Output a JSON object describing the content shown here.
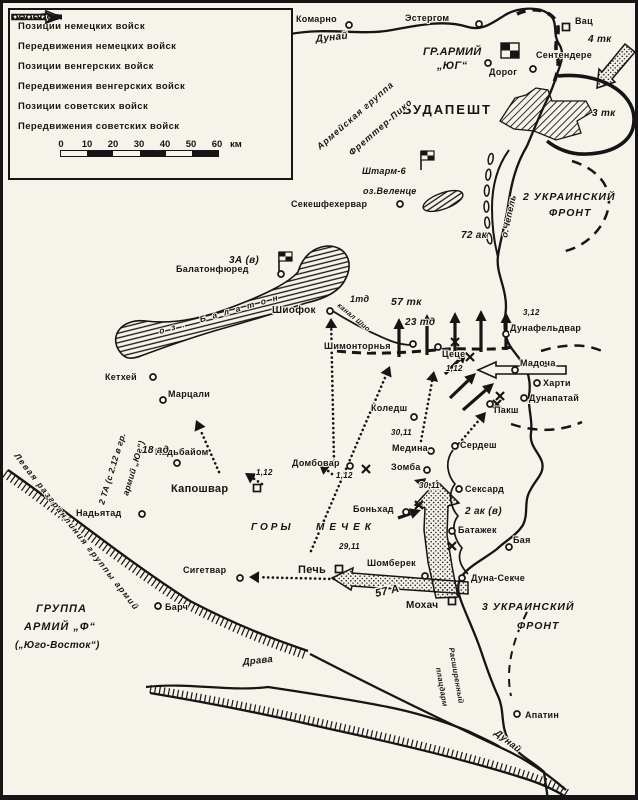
{
  "colors": {
    "paper": "#f5f3ea",
    "ink": "#151515"
  },
  "legend": {
    "items": [
      {
        "id": "german-positions",
        "label": "Позиции немецких войск"
      },
      {
        "id": "german-movements",
        "label": "Передвижения немецких войск"
      },
      {
        "id": "hungarian-positions",
        "label": "Позиции венгерских войск"
      },
      {
        "id": "hungarian-movements",
        "label": "Передвижения венгерских войск"
      },
      {
        "id": "soviet-positions",
        "label": "Позиции советских войск"
      },
      {
        "id": "soviet-movements",
        "label": "Передвижения советских войск"
      }
    ],
    "scale": {
      "ticks": [
        "0",
        "10",
        "20",
        "30",
        "40",
        "50",
        "60"
      ],
      "unit": "км"
    }
  },
  "map": {
    "cities": [
      {
        "n": "Комарно",
        "m": "c",
        "mx": 349,
        "my": 25,
        "lx": 296,
        "ly": 22
      },
      {
        "n": "Эстергом",
        "m": "c",
        "mx": 479,
        "my": 24,
        "lx": 405,
        "ly": 21
      },
      {
        "n": "Вац",
        "m": "s",
        "mx": 566,
        "my": 27,
        "lx": 575,
        "ly": 24
      },
      {
        "n": "Сентендере",
        "m": "c",
        "mx": 533,
        "my": 69,
        "lx": 536,
        "ly": 58
      },
      {
        "n": "Дорог",
        "m": "c",
        "mx": 488,
        "my": 63,
        "lx": 489,
        "ly": 75
      },
      {
        "n": "Секешфехервар",
        "m": "c",
        "mx": 400,
        "my": 204,
        "lx": 291,
        "ly": 207
      },
      {
        "n": "Балатонфюред",
        "m": "c",
        "mx": 281,
        "my": 274,
        "lx": 176,
        "ly": 272
      },
      {
        "n": "Шиофок",
        "m": "c",
        "mx": 330,
        "my": 311,
        "lx": 272,
        "ly": 313,
        "s": 10
      },
      {
        "n": "Кетхей",
        "m": "c",
        "mx": 153,
        "my": 377,
        "lx": 105,
        "ly": 380
      },
      {
        "n": "Марцали",
        "m": "c",
        "mx": 163,
        "my": 400,
        "lx": 168,
        "ly": 397
      },
      {
        "n": "Надьбайом",
        "m": "c",
        "mx": 177,
        "my": 463,
        "lx": 155,
        "ly": 455
      },
      {
        "n": "Надьятад",
        "m": "c",
        "mx": 142,
        "my": 514,
        "lx": 76,
        "ly": 516
      },
      {
        "n": "Капошвар",
        "m": "s",
        "mx": 257,
        "my": 488,
        "lx": 171,
        "ly": 492,
        "s": 11
      },
      {
        "n": "Домбовар",
        "m": "c",
        "mx": 350,
        "my": 466,
        "lx": 292,
        "ly": 466
      },
      {
        "n": "Сигетвар",
        "m": "c",
        "mx": 240,
        "my": 578,
        "lx": 183,
        "ly": 573
      },
      {
        "n": "Печь",
        "m": "s",
        "mx": 339,
        "my": 569,
        "lx": 298,
        "ly": 573,
        "s": 11
      },
      {
        "n": "Шомберек",
        "m": "c",
        "mx": 425,
        "my": 576,
        "lx": 367,
        "ly": 566
      },
      {
        "n": "Барч",
        "m": "c",
        "mx": 158,
        "my": 606,
        "lx": 165,
        "ly": 610
      },
      {
        "n": "Мохач",
        "m": "s",
        "mx": 452,
        "my": 601,
        "lx": 406,
        "ly": 608,
        "s": 10
      },
      {
        "n": "Дуна-Секче",
        "m": "c",
        "mx": 462,
        "my": 578,
        "lx": 471,
        "ly": 581
      },
      {
        "n": "Батажек",
        "m": "c",
        "mx": 452,
        "my": 531,
        "lx": 458,
        "ly": 533
      },
      {
        "n": "Бая",
        "m": "c",
        "mx": 509,
        "my": 547,
        "lx": 513,
        "ly": 543
      },
      {
        "n": "Сексард",
        "m": "c",
        "mx": 459,
        "my": 489,
        "lx": 465,
        "ly": 492
      },
      {
        "n": "Сердеш",
        "m": "c",
        "mx": 455,
        "my": 446,
        "lx": 460,
        "ly": 448
      },
      {
        "n": "Пакш",
        "m": "c",
        "mx": 490,
        "my": 404,
        "lx": 494,
        "ly": 413
      },
      {
        "n": "Дунапатай",
        "m": "c",
        "mx": 524,
        "my": 398,
        "lx": 529,
        "ly": 401
      },
      {
        "n": "Харти",
        "m": "c",
        "mx": 537,
        "my": 383,
        "lx": 543,
        "ly": 386
      },
      {
        "n": "Мадоча",
        "m": "c",
        "mx": 515,
        "my": 370,
        "lx": 520,
        "ly": 366
      },
      {
        "n": "Дунафельдвар",
        "m": "c",
        "mx": 506,
        "my": 334,
        "lx": 510,
        "ly": 331
      },
      {
        "n": "Цеце",
        "m": "c",
        "mx": 438,
        "my": 347,
        "lx": 442,
        "ly": 357
      },
      {
        "n": "Шимонторнья",
        "m": "c",
        "mx": 413,
        "my": 344,
        "lx": 324,
        "ly": 349
      },
      {
        "n": "Коледш",
        "m": "c",
        "mx": 414,
        "my": 417,
        "lx": 371,
        "ly": 411
      },
      {
        "n": "Медина",
        "m": "c",
        "mx": 431,
        "my": 451,
        "lx": 392,
        "ly": 451
      },
      {
        "n": "Зомба",
        "m": "c",
        "mx": 427,
        "my": 470,
        "lx": 391,
        "ly": 470
      },
      {
        "n": "Боньхад",
        "m": "c",
        "mx": 406,
        "my": 512,
        "lx": 353,
        "ly": 512
      },
      {
        "n": "Апатин",
        "m": "c",
        "mx": 517,
        "my": 714,
        "lx": 525,
        "ly": 718
      }
    ],
    "labels": [
      {
        "t": "БУДАПЕШТ",
        "x": 402,
        "y": 114,
        "s": 13,
        "ls": 2
      },
      {
        "t": "ГР.АРМИЙ",
        "x": 423,
        "y": 55,
        "s": 11,
        "i": 1
      },
      {
        "t": "„ЮГ“",
        "x": 437,
        "y": 69,
        "s": 11,
        "i": 1
      },
      {
        "t": "2 УКРАИНСКИЙ",
        "x": 523,
        "y": 200,
        "s": 10.5,
        "i": 1,
        "ls": 1
      },
      {
        "t": "ФРОНТ",
        "x": 549,
        "y": 216,
        "s": 10.5,
        "i": 1,
        "ls": 1
      },
      {
        "t": "3 УКРАИНСКИЙ",
        "x": 482,
        "y": 610,
        "s": 10.5,
        "i": 1,
        "ls": 1
      },
      {
        "t": "ФРОНТ",
        "x": 517,
        "y": 629,
        "s": 10.5,
        "i": 1,
        "ls": 1
      },
      {
        "t": "ГРУППА",
        "x": 36,
        "y": 612,
        "s": 11,
        "i": 1,
        "ls": 1
      },
      {
        "t": "АРМИЙ „Ф“",
        "x": 24,
        "y": 630,
        "s": 11,
        "i": 1,
        "ls": 1
      },
      {
        "t": "(„Юго-Восток“)",
        "x": 15,
        "y": 648,
        "s": 10,
        "i": 1
      },
      {
        "t": "ГОРЫ",
        "x": 251,
        "y": 530,
        "s": 10,
        "i": 1,
        "ls": 3
      },
      {
        "t": "МЕЧЕК",
        "x": 316,
        "y": 530,
        "s": 10,
        "i": 1,
        "ls": 5
      },
      {
        "t": "Армейская группа",
        "x": 320,
        "y": 150,
        "s": 9,
        "i": 1,
        "r": -41,
        "ls": 1
      },
      {
        "t": "Фреттер-Пико",
        "x": 352,
        "y": 156,
        "s": 9,
        "i": 1,
        "r": -41,
        "ls": 1
      },
      {
        "t": "2 ТА (с 2.12 в гр.",
        "x": 104,
        "y": 505,
        "s": 8.5,
        "i": 1,
        "r": -73
      },
      {
        "t": "армий „Юг“)",
        "x": 128,
        "y": 496,
        "s": 8.5,
        "i": 1,
        "r": -73
      },
      {
        "t": "Левая разгранлиния группы армий",
        "x": 14,
        "y": 456,
        "s": 8.5,
        "i": 1,
        "r": 52,
        "ls": 1.5
      },
      {
        "t": "Штарм-6",
        "x": 362,
        "y": 174,
        "s": 9,
        "i": 1
      },
      {
        "t": "Расширенный",
        "x": 449,
        "y": 648,
        "s": 7.5,
        "i": 1,
        "r": 80
      },
      {
        "t": "плацдарм",
        "x": 436,
        "y": 668,
        "s": 7.5,
        "i": 1,
        "r": 80
      },
      {
        "t": "Дунай",
        "x": 316,
        "y": 42,
        "s": 10,
        "i": 1,
        "r": -6
      },
      {
        "t": "Дунай",
        "x": 494,
        "y": 734,
        "s": 9.5,
        "i": 1,
        "r": 38
      },
      {
        "t": "Драва",
        "x": 243,
        "y": 665,
        "s": 9.5,
        "i": 1,
        "r": -6
      },
      {
        "t": "канал Шио",
        "x": 337,
        "y": 306,
        "s": 7,
        "i": 1,
        "r": 40
      },
      {
        "t": "оз.Веленце",
        "x": 363,
        "y": 194,
        "s": 9,
        "i": 1
      },
      {
        "t": "оз. Балатон",
        "x": 160,
        "y": 334,
        "s": 8.5,
        "i": 1,
        "r": -16,
        "ls": 7
      },
      {
        "t": "о.Чепель",
        "x": 507,
        "y": 238,
        "s": 9,
        "i": 1,
        "r": -78
      },
      {
        "t": "4 тк",
        "x": 588,
        "y": 42,
        "s": 10,
        "i": 1
      },
      {
        "t": "3 тк",
        "x": 592,
        "y": 116,
        "s": 10,
        "i": 1
      },
      {
        "t": "72 ак",
        "x": 461,
        "y": 238,
        "s": 10,
        "i": 1
      },
      {
        "t": "57 тк",
        "x": 391,
        "y": 305,
        "s": 10.5,
        "i": 1
      },
      {
        "t": "23 тд",
        "x": 405,
        "y": 325,
        "s": 10,
        "i": 1
      },
      {
        "t": "1тд",
        "x": 350,
        "y": 302,
        "s": 9,
        "i": 1
      },
      {
        "t": "3А (в)",
        "x": 229,
        "y": 263,
        "s": 10,
        "i": 1
      },
      {
        "t": "2 ак (в)",
        "x": 465,
        "y": 514,
        "s": 10,
        "i": 1
      },
      {
        "t": "18 ад",
        "x": 142,
        "y": 453,
        "s": 10,
        "i": 1
      },
      {
        "t": "57 А",
        "x": 376,
        "y": 597,
        "s": 11,
        "i": 1,
        "r": -13,
        "halo": 3
      },
      {
        "t": "1,12",
        "x": 446,
        "y": 371,
        "s": 8,
        "i": 1
      },
      {
        "t": "3,12",
        "x": 523,
        "y": 315,
        "s": 8,
        "i": 1
      },
      {
        "t": "1,12",
        "x": 256,
        "y": 475,
        "s": 8,
        "i": 1
      },
      {
        "t": "1,12",
        "x": 336,
        "y": 478,
        "s": 8,
        "i": 1
      },
      {
        "t": "29,11",
        "x": 339,
        "y": 549,
        "s": 8,
        "i": 1
      },
      {
        "t": "30,11",
        "x": 391,
        "y": 435,
        "s": 8,
        "i": 1
      },
      {
        "t": "30,11",
        "x": 419,
        "y": 488,
        "s": 8,
        "i": 1
      }
    ]
  }
}
